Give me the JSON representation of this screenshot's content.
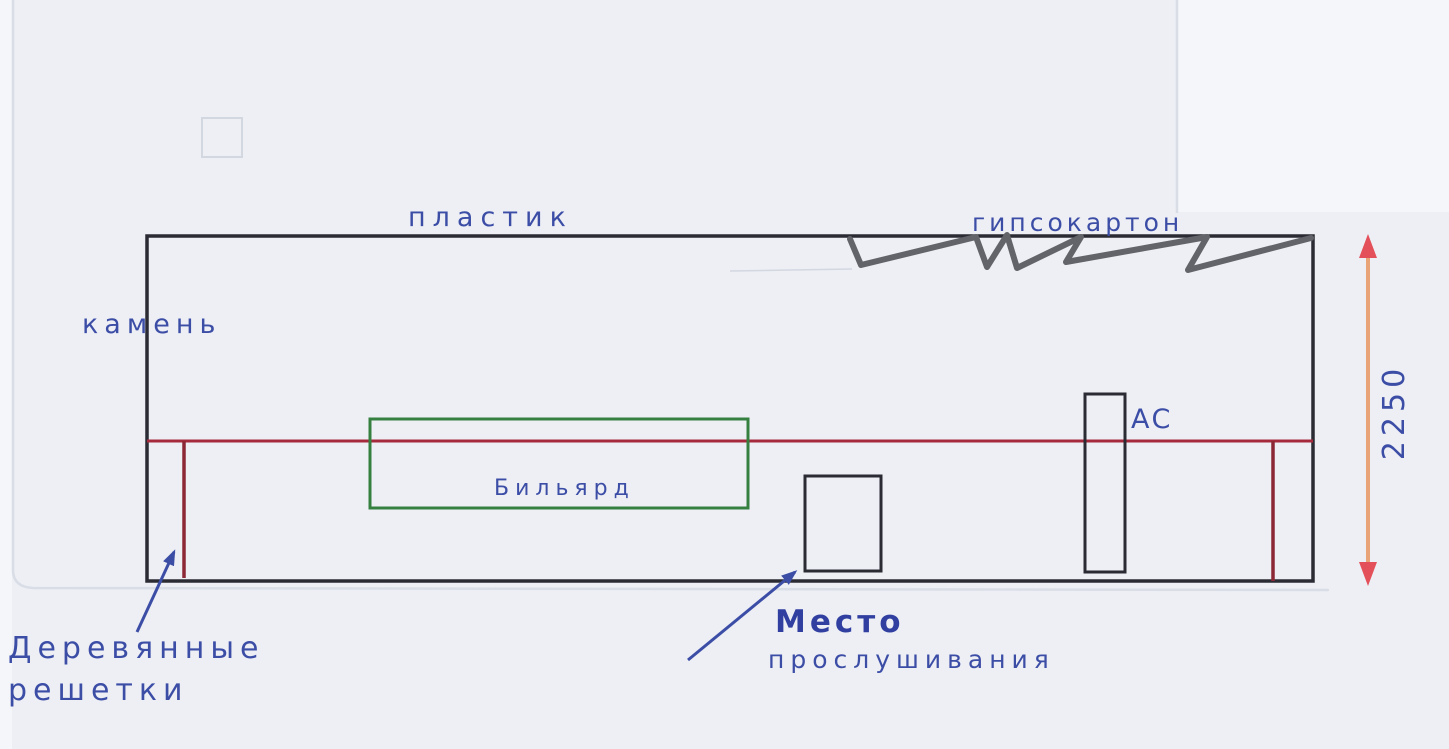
{
  "sketch": {
    "description_labels": {
      "plastic": "пластик",
      "drywall": "гипсокартон",
      "stone": "камень",
      "billiard": "Бильярд",
      "speakers": "АС",
      "listening_1": "Место",
      "listening_2": "прослушивания",
      "grilles_1": "Деревянные",
      "grilles_2": "решетки",
      "height_dim": "2250"
    },
    "elements": {
      "room": "прямоугольная комната",
      "top_wall_materials": [
        "пластик",
        "гипсокартон"
      ],
      "left_wall_material": "камень",
      "objects": [
        "Бильярд",
        "Место прослушивания",
        "АС",
        "Деревянные решетки"
      ],
      "vertical_dimension": "2250"
    }
  },
  "colors": {
    "paper_bg": "#edeff5",
    "outside_bg": "#f4f6fa",
    "wall_line": "#2b2b33",
    "red_line": "#a52a3c",
    "grille_line": "#8c2836",
    "billiard_outline": "#35803f",
    "ink_blue": "#3c4da6",
    "ink_blue_bold": "#303fa0",
    "pencil_gray": "#63636a",
    "dim_shaft": "#e8a476",
    "dim_head": "#e4505a",
    "paper_edge": "#d9dde6",
    "faint_pencil": "#d3d7e0"
  }
}
